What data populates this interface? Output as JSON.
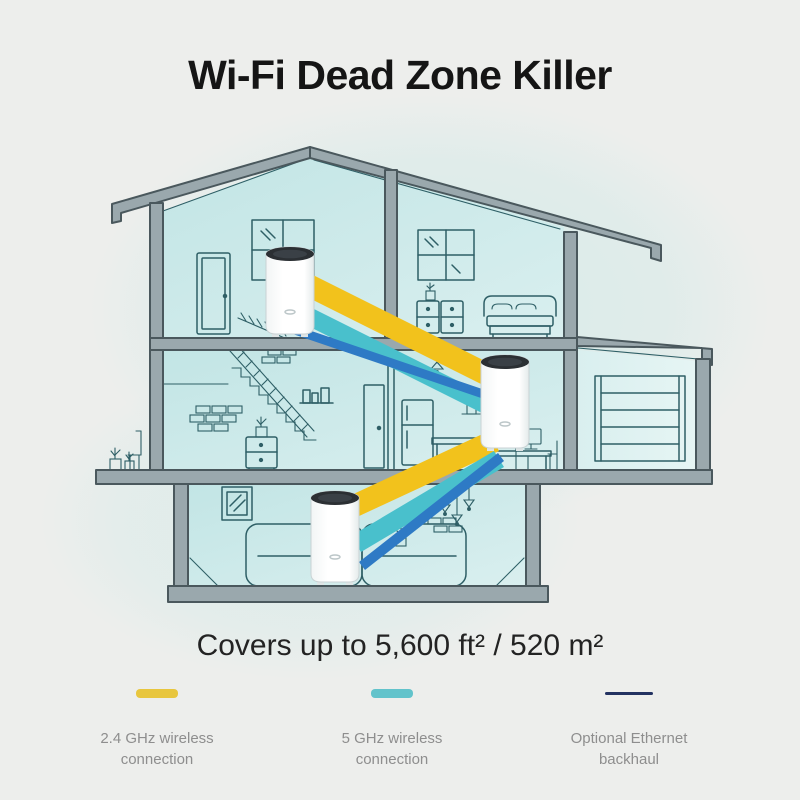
{
  "title": "Wi-Fi Dead Zone Killer",
  "coverage_text": "Covers up to 5,600 ft² / 520 m²",
  "legend": {
    "items": [
      {
        "label": "2.4 GHz wireless connection",
        "line1": "2.4 GHz wireless",
        "line2": "connection",
        "color": "#e8c63e",
        "style": "thick"
      },
      {
        "label": "5 GHz wireless connection",
        "line1": "5 GHz wireless",
        "line2": "connection",
        "color": "#62c3cb",
        "style": "thick"
      },
      {
        "label": "Optional Ethernet backhaul",
        "line1": "Optional Ethernet",
        "line2": "backhaul",
        "color": "#233261",
        "style": "thin"
      }
    ]
  },
  "illustration": {
    "units": [
      "deco-unit-attic",
      "deco-unit-kitchen",
      "deco-unit-living-room"
    ],
    "colors": {
      "band_24ghz": "#f2c21c",
      "band_5ghz": "#49c0cc",
      "band_ethernet": "#2e7ac5",
      "structure_fill": "#9aa8ad",
      "structure_outline": "#4a585d",
      "interior_line": "#2e5f66",
      "room_fill": "#c2e5e5",
      "room_fill_light": "#d9efef",
      "unit_top": "#2b2f33",
      "unit_body": "#ffffff",
      "background": "#edeeec",
      "glow": "#d6ebe9"
    }
  }
}
